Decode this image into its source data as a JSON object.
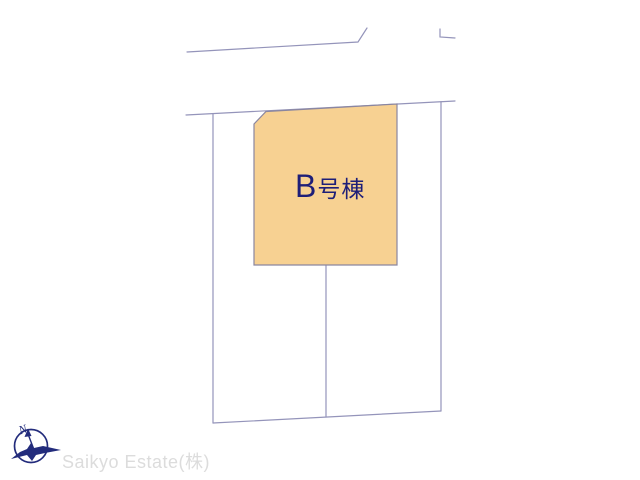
{
  "plan": {
    "plot_label": "B号棟",
    "plot_fill": "#f7d192",
    "plot_outline": "#8a86a0",
    "line_color": "#9494ba",
    "label_color": "#1e1e78"
  },
  "compass": {
    "north_label": "N",
    "color": "#232c7c"
  },
  "watermark": {
    "company": "Saikyo Estate(株)",
    "color": "#dcdcdc"
  }
}
